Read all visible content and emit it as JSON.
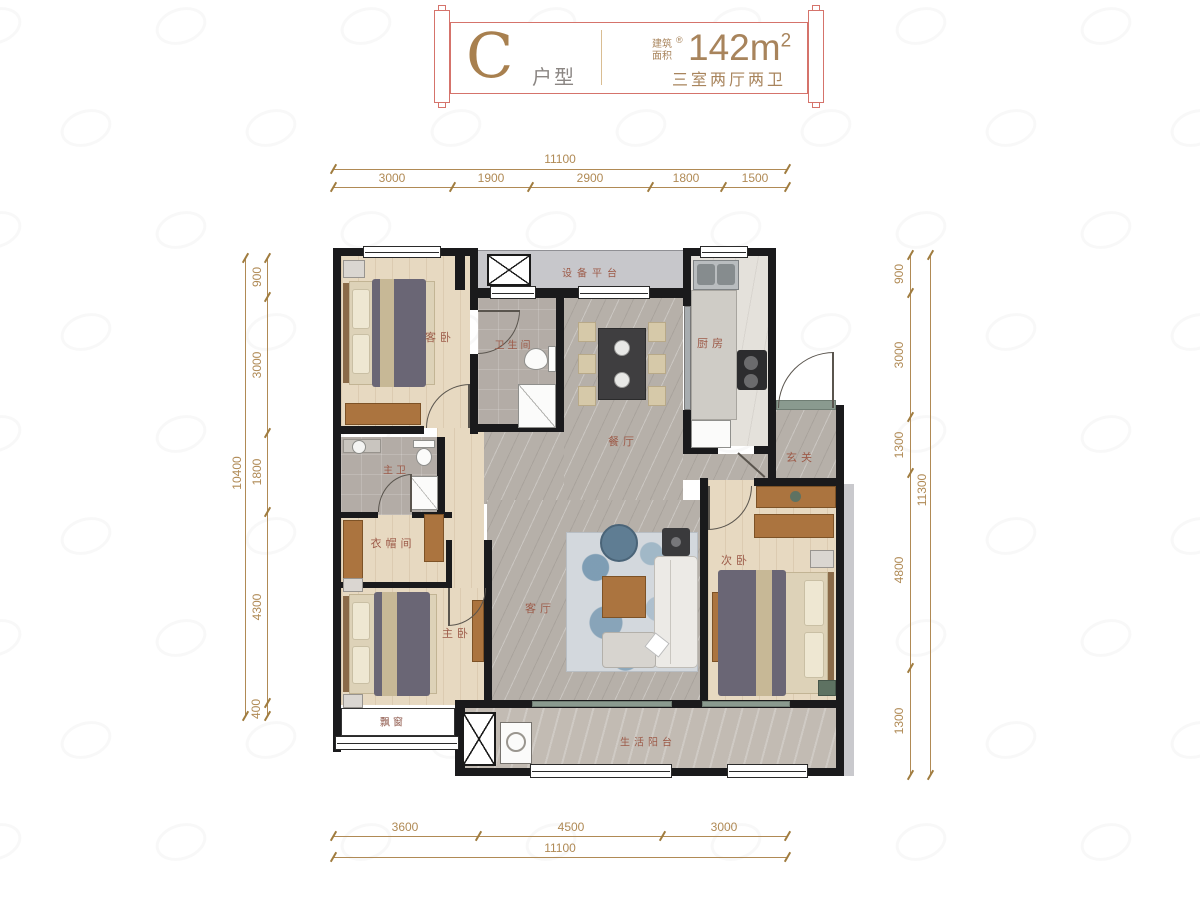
{
  "banner": {
    "type_letter": "C",
    "type_suffix": "户型",
    "area_prefix_line1": "建筑",
    "area_prefix_line2": "面积",
    "area_reg": "®",
    "area_value": "142m",
    "area_exp": "2",
    "spec": "三室两厅两卫"
  },
  "dimensions": {
    "top": {
      "total": "11100",
      "segments": [
        "3000",
        "1900",
        "2900",
        "1800",
        "1500"
      ]
    },
    "bottom": {
      "total": "11100",
      "segments": [
        "3600",
        "4500",
        "3000"
      ]
    },
    "left": {
      "total": "10400",
      "segments": [
        "900",
        "3000",
        "1800",
        "4300",
        "400"
      ]
    },
    "right": {
      "total": "11300",
      "segments": [
        "900",
        "3000",
        "1300",
        "4800",
        "1300"
      ]
    }
  },
  "rooms": {
    "equipment_platform": "设备平台",
    "guest_bedroom": "客卧",
    "bathroom": "卫生间",
    "dining": "餐厅",
    "kitchen": "厨房",
    "entry": "玄关",
    "master_bath": "主卫",
    "closet": "衣帽间",
    "master_bedroom": "主卧",
    "living": "客厅",
    "second_bedroom": "次卧",
    "bay_window": "飘窗",
    "balcony": "生活阳台"
  },
  "colors": {
    "banner_border": "#d5736b",
    "gold": "#a8845c",
    "dim": "#b08a55",
    "room_label": "#9d5b49",
    "wall": "#1a1a1c"
  }
}
